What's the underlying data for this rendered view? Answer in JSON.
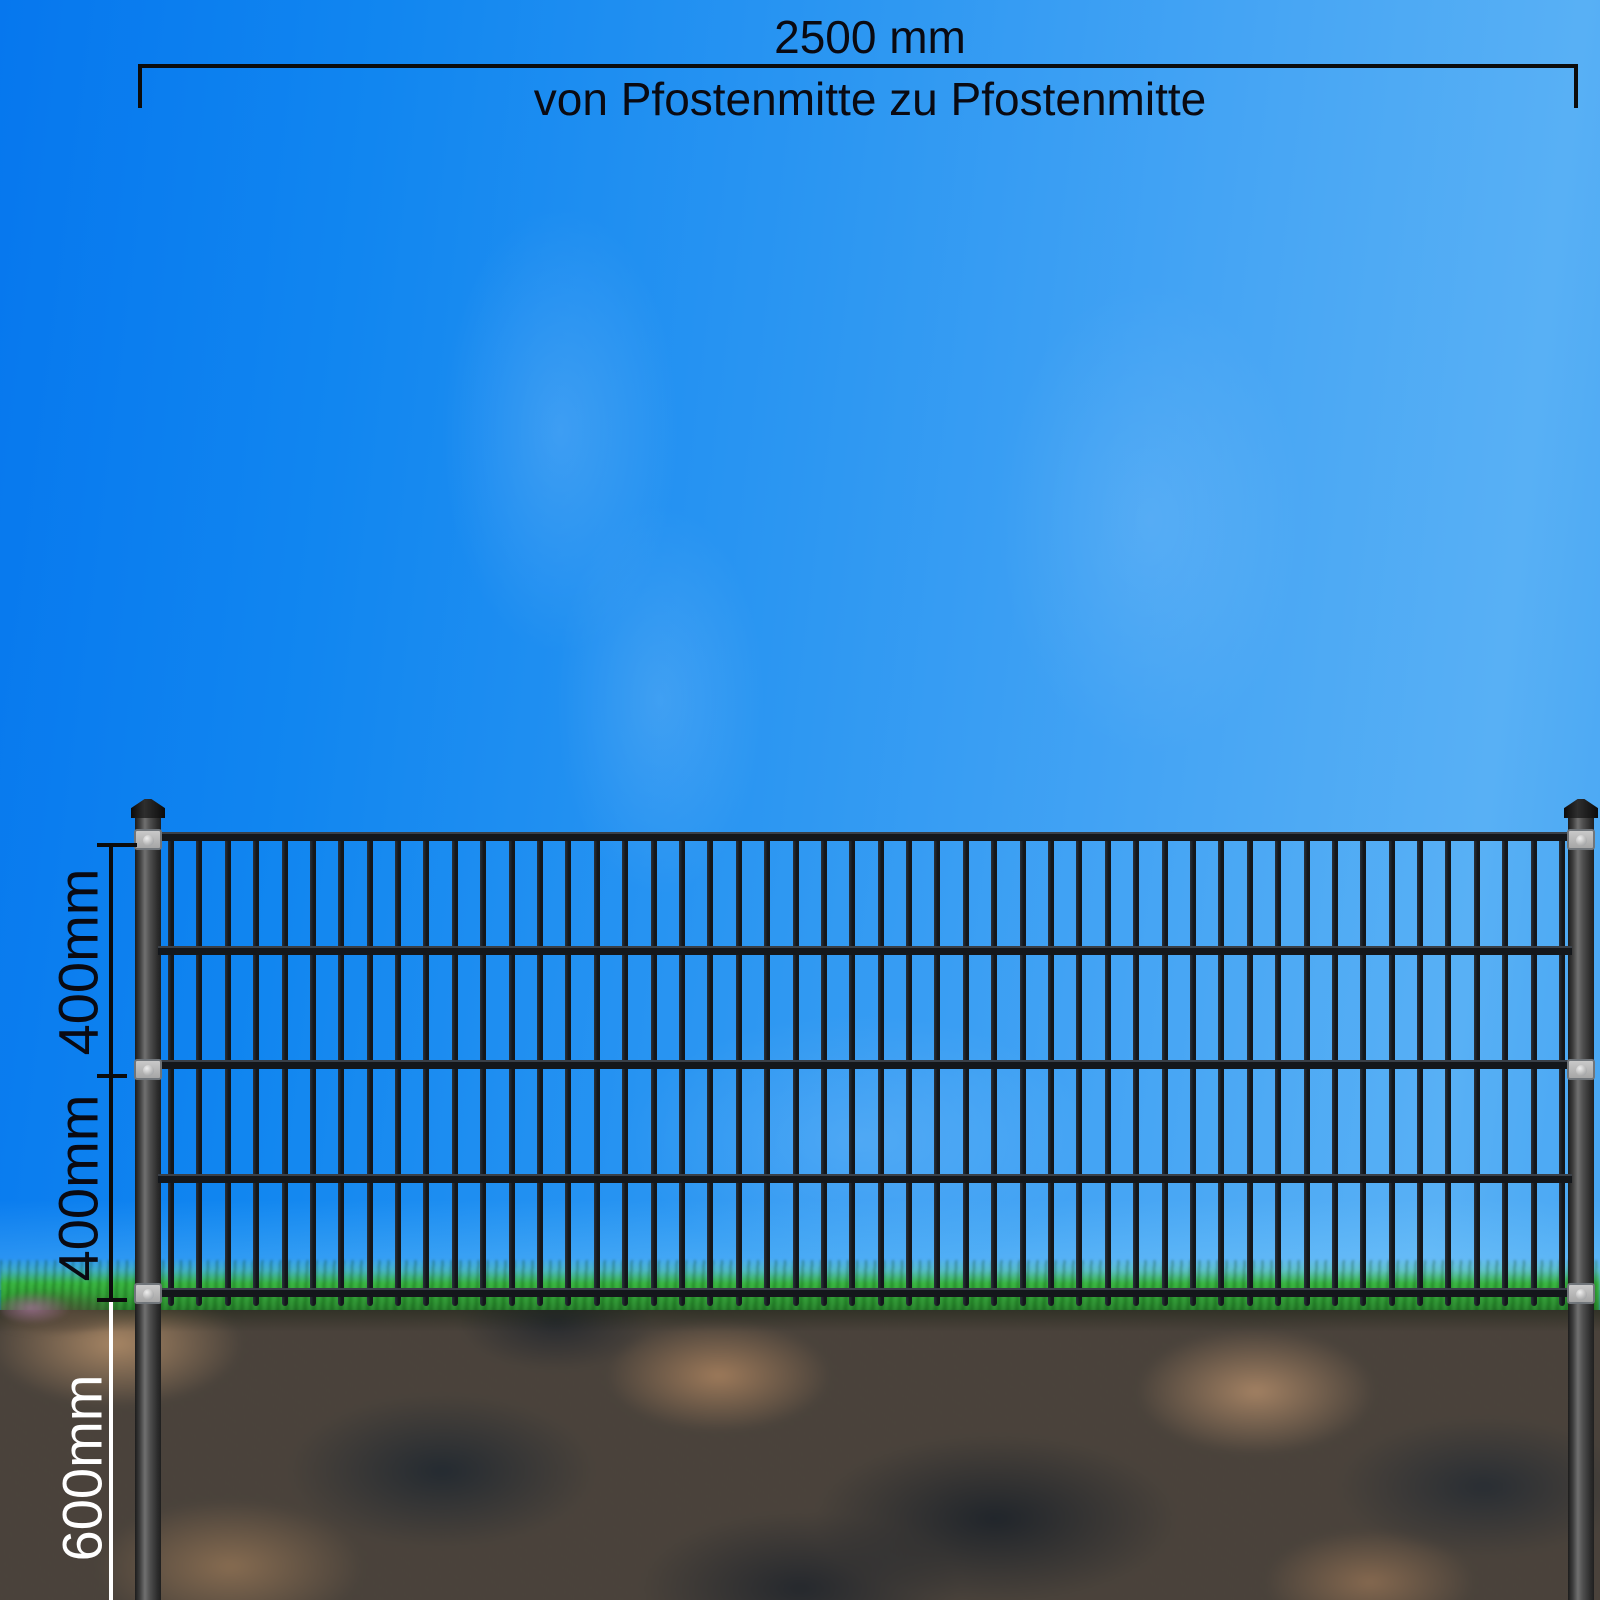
{
  "annotations": {
    "width": {
      "value": "2500 mm",
      "caption": "von Pfostenmitte zu Pfostenmitte"
    },
    "heights": {
      "upper_field": "400mm",
      "lower_field": "400mm",
      "below_ground": "600mm"
    }
  },
  "fence": {
    "vertical_bar_count": 50,
    "rail_count": 5,
    "post_count": 2,
    "clamp_rows_per_post": 3
  },
  "colors": {
    "sky_deep_blue": "#0677ee",
    "sky_light_blue": "#58b0f5",
    "grass_green": "#2f9e33",
    "soil_brown": "#4a423a",
    "fence_metal": "#14171b",
    "post_gray": "#4a4a4a",
    "clamp_gray": "#b5b5b5",
    "dimension_line_black": "#0c0c0c",
    "dimension_line_white": "#ffffff"
  }
}
